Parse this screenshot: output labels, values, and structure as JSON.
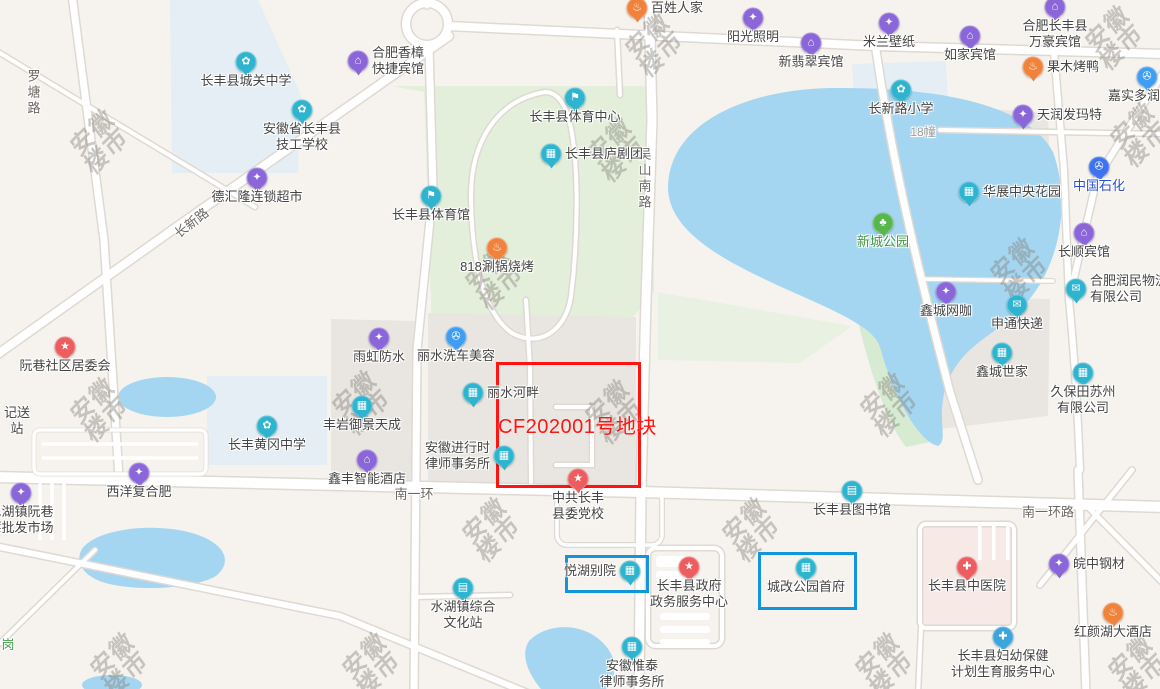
{
  "map": {
    "width": 1160,
    "height": 689
  },
  "watermark": {
    "text_lines": [
      "安徽",
      "楼市"
    ]
  },
  "annotation": {
    "plot_label": "CF202001号地块",
    "plot_label_pos": {
      "x": 498,
      "y": 410
    },
    "plot_box": {
      "x": 496,
      "y": 362,
      "w": 139,
      "h": 120,
      "color": "#ff1412"
    },
    "highlight_boxes": [
      {
        "label": "悦湖别院",
        "x": 565,
        "y": 555,
        "w": 78,
        "h": 32,
        "color": "#1296db"
      },
      {
        "label": "城改公园首府",
        "x": 758,
        "y": 552,
        "w": 93,
        "h": 52,
        "color": "#1296db"
      }
    ]
  },
  "road_labels": [
    {
      "text": "罗塘路",
      "x": 33,
      "y": 93,
      "orientation": "vertical"
    },
    {
      "text": "长新路",
      "x": 191,
      "y": 222,
      "rotate": -38
    },
    {
      "text": "吴山南路",
      "x": 644,
      "y": 179,
      "orientation": "vertical"
    },
    {
      "text": "南一环",
      "x": 414,
      "y": 493,
      "orientation": "horizontal"
    },
    {
      "text": "南一环路",
      "x": 1048,
      "y": 511,
      "orientation": "horizontal"
    }
  ],
  "categories": {
    "school": {
      "color": "#2eb4ce",
      "glyph": "✿"
    },
    "sports": {
      "color": "#2eb4ce",
      "glyph": "⚑"
    },
    "theater": {
      "color": "#2eb4ce",
      "glyph": "▦"
    },
    "building": {
      "color": "#2eb4ce",
      "glyph": "▦"
    },
    "culture": {
      "color": "#2eb4ce",
      "glyph": "▤"
    },
    "library": {
      "color": "#2eb4ce",
      "glyph": "▤"
    },
    "law": {
      "color": "#2eb4ce",
      "glyph": "▦"
    },
    "logistics": {
      "color": "#2eb4ce",
      "glyph": "✉"
    },
    "express": {
      "color": "#2eb4ce",
      "glyph": "✉"
    },
    "company": {
      "color": "#2eb4ce",
      "glyph": "▦"
    },
    "hotel": {
      "color": "#8a66d9",
      "glyph": "⌂"
    },
    "shop": {
      "color": "#8a66d9",
      "glyph": "✦"
    },
    "netcafe": {
      "color": "#8a66d9",
      "glyph": "✦"
    },
    "market": {
      "color": "#8a66d9",
      "glyph": "✦"
    },
    "food": {
      "color": "#f0823c",
      "glyph": "♨"
    },
    "committee": {
      "color": "#ed5c5e",
      "glyph": "★"
    },
    "party": {
      "color": "#ed5c5e",
      "glyph": "★"
    },
    "government": {
      "color": "#ed5c5e",
      "glyph": "★"
    },
    "hospital": {
      "color": "#ed5c5e",
      "glyph": "✚"
    },
    "health": {
      "color": "#3ba5dc",
      "glyph": "✚"
    },
    "park": {
      "color": "#58b64d",
      "glyph": "♣"
    },
    "car": {
      "color": "#3f9ef2",
      "glyph": "✇"
    },
    "gas": {
      "color": "#3e73ee",
      "glyph": "✇"
    }
  },
  "pois": [
    {
      "name": "长丰县城关中学",
      "category": "school",
      "x": 246,
      "y": 62,
      "label_pos": "below"
    },
    {
      "name": "安徽省长丰县技工学校",
      "lines": [
        "安徽省长丰县",
        "技工学校"
      ],
      "category": "school",
      "x": 302,
      "y": 110,
      "label_pos": "below"
    },
    {
      "name": "合肥香樟快捷宾馆",
      "lines": [
        "合肥香樟",
        "快捷宾馆"
      ],
      "category": "hotel",
      "x": 358,
      "y": 61,
      "label_pos": "right"
    },
    {
      "name": "德汇隆连锁超市",
      "category": "shop",
      "x": 257,
      "y": 178,
      "label_pos": "below"
    },
    {
      "name": "百姓人家",
      "category": "food",
      "x": 637,
      "y": 8,
      "label_pos": "right"
    },
    {
      "name": "阳光照明",
      "category": "shop",
      "x": 753,
      "y": 18,
      "label_pos": "below"
    },
    {
      "name": "新翡翠宾馆",
      "category": "hotel",
      "x": 811,
      "y": 43,
      "label_pos": "below"
    },
    {
      "name": "米兰壁纸",
      "category": "shop",
      "x": 889,
      "y": 23,
      "label_pos": "below"
    },
    {
      "name": "如家宾馆",
      "category": "hotel",
      "x": 970,
      "y": 36,
      "label_pos": "below"
    },
    {
      "name": "合肥长丰县万豪宾馆",
      "lines": [
        "合肥长丰县",
        "万豪宾馆"
      ],
      "category": "hotel",
      "x": 1055,
      "y": 7,
      "label_pos": "below"
    },
    {
      "name": "果木烤鸭",
      "category": "food",
      "x": 1033,
      "y": 67,
      "label_pos": "right"
    },
    {
      "name": "嘉实多润滑油",
      "category": "car",
      "x": 1147,
      "y": 77,
      "label_pos": "below"
    },
    {
      "name": "长新路小学",
      "category": "school",
      "x": 901,
      "y": 90,
      "label_pos": "below"
    },
    {
      "name": "18幢",
      "x": 923,
      "y": 132,
      "label_pos": "center",
      "label_color": "#a09d98",
      "label_size": 12
    },
    {
      "name": "天润发玛特",
      "category": "shop",
      "x": 1023,
      "y": 115,
      "label_pos": "right"
    },
    {
      "name": "中国石化",
      "category": "gas",
      "x": 1099,
      "y": 167,
      "label_pos": "below",
      "label_color": "#2c50c8"
    },
    {
      "name": "华展中央花园",
      "category": "building",
      "x": 969,
      "y": 192,
      "label_pos": "right"
    },
    {
      "name": "长丰县体育中心",
      "category": "sports",
      "x": 575,
      "y": 98,
      "label_pos": "below"
    },
    {
      "name": "长丰县庐剧团",
      "category": "theater",
      "x": 551,
      "y": 154,
      "label_pos": "right"
    },
    {
      "name": "长丰县体育馆",
      "category": "sports",
      "x": 431,
      "y": 196,
      "label_pos": "below"
    },
    {
      "name": "818涮锅烧烤",
      "category": "food",
      "x": 497,
      "y": 248,
      "label_pos": "below"
    },
    {
      "name": "新城公园",
      "category": "park",
      "x": 883,
      "y": 223,
      "label_pos": "below",
      "label_color": "#3f9a3d"
    },
    {
      "name": "长顺宾馆",
      "category": "hotel",
      "x": 1084,
      "y": 233,
      "label_pos": "below"
    },
    {
      "name": "合肥润民物流有限公司",
      "lines": [
        "合肥润民物流",
        "有限公司"
      ],
      "category": "logistics",
      "x": 1076,
      "y": 289,
      "label_pos": "right"
    },
    {
      "name": "鑫城网咖",
      "category": "netcafe",
      "x": 946,
      "y": 292,
      "label_pos": "below"
    },
    {
      "name": "申通快递",
      "category": "express",
      "x": 1017,
      "y": 305,
      "label_pos": "below"
    },
    {
      "name": "鑫城世家",
      "category": "building",
      "x": 1002,
      "y": 353,
      "label_pos": "below"
    },
    {
      "name": "久保田苏州有限公司",
      "lines": [
        "久保田苏州",
        "有限公司"
      ],
      "category": "company",
      "x": 1083,
      "y": 373,
      "label_pos": "below"
    },
    {
      "name": "阮巷社区居委会",
      "category": "committee",
      "x": 65,
      "y": 347,
      "label_pos": "below"
    },
    {
      "name": "雨虹防水",
      "category": "shop",
      "x": 379,
      "y": 338,
      "label_pos": "below"
    },
    {
      "name": "丽水洗车美容",
      "category": "car",
      "x": 456,
      "y": 337,
      "label_pos": "below"
    },
    {
      "name": "丽水河畔",
      "category": "building",
      "x": 473,
      "y": 393,
      "label_pos": "right"
    },
    {
      "name": "长丰黄冈中学",
      "category": "school",
      "x": 267,
      "y": 426,
      "label_pos": "below"
    },
    {
      "name": "丰岩御景天成",
      "category": "building",
      "x": 362,
      "y": 406,
      "label_pos": "below"
    },
    {
      "name": "安徽进行时律师事务所",
      "lines": [
        "安徽进行时",
        "律师事务所"
      ],
      "category": "law",
      "x": 504,
      "y": 456,
      "label_pos": "left"
    },
    {
      "name": "鑫丰智能酒店",
      "category": "hotel",
      "x": 367,
      "y": 460,
      "label_pos": "below"
    },
    {
      "name": "西洋复合肥",
      "category": "shop",
      "x": 139,
      "y": 473,
      "label_pos": "below"
    },
    {
      "name": "配送站",
      "lines": [
        "记送",
        "站"
      ],
      "x": 17,
      "y": 421,
      "label_pos": "center"
    },
    {
      "name": "水湖镇阮巷莓批发市场",
      "lines": [
        "水湖镇阮巷",
        "莓批发市场"
      ],
      "category": "market",
      "x": 21,
      "y": 493,
      "label_pos": "below"
    },
    {
      "name": "中共长丰县委党校",
      "lines": [
        "中共长丰",
        "县委党校"
      ],
      "category": "party",
      "x": 578,
      "y": 479,
      "label_pos": "below"
    },
    {
      "name": "长丰县图书馆",
      "category": "library",
      "x": 852,
      "y": 491,
      "label_pos": "below"
    },
    {
      "name": "悦湖别院",
      "category": "building",
      "x": 630,
      "y": 571,
      "label_pos": "left"
    },
    {
      "name": "长丰县政府政务服务中心",
      "lines": [
        "长丰县政府",
        "政务服务中心"
      ],
      "category": "government",
      "x": 689,
      "y": 567,
      "label_pos": "below"
    },
    {
      "name": "城改公园首府",
      "category": "building",
      "x": 806,
      "y": 568,
      "label_pos": "below"
    },
    {
      "name": "皖中钢材",
      "category": "shop",
      "x": 1059,
      "y": 564,
      "label_pos": "right"
    },
    {
      "name": "长丰县中医院",
      "category": "hospital",
      "x": 967,
      "y": 567,
      "label_pos": "below"
    },
    {
      "name": "红颜湖大酒店",
      "category": "food",
      "x": 1113,
      "y": 613,
      "label_pos": "below"
    },
    {
      "name": "长丰县妇幼保健计划生育服务中心",
      "lines": [
        "长丰县妇幼保健",
        "计划生育服务中心"
      ],
      "category": "health",
      "x": 1003,
      "y": 637,
      "label_pos": "below"
    },
    {
      "name": "水湖镇综合文化站",
      "lines": [
        "水湖镇综合",
        "文化站"
      ],
      "category": "culture",
      "x": 463,
      "y": 588,
      "label_pos": "below"
    },
    {
      "name": "安徽惟泰律师事务所",
      "lines": [
        "安徽惟泰",
        "律师事务所"
      ],
      "category": "law",
      "x": 632,
      "y": 647,
      "label_pos": "below"
    },
    {
      "name": "岗",
      "x": 8,
      "y": 645,
      "label_pos": "center",
      "label_color": "#43a048"
    }
  ]
}
